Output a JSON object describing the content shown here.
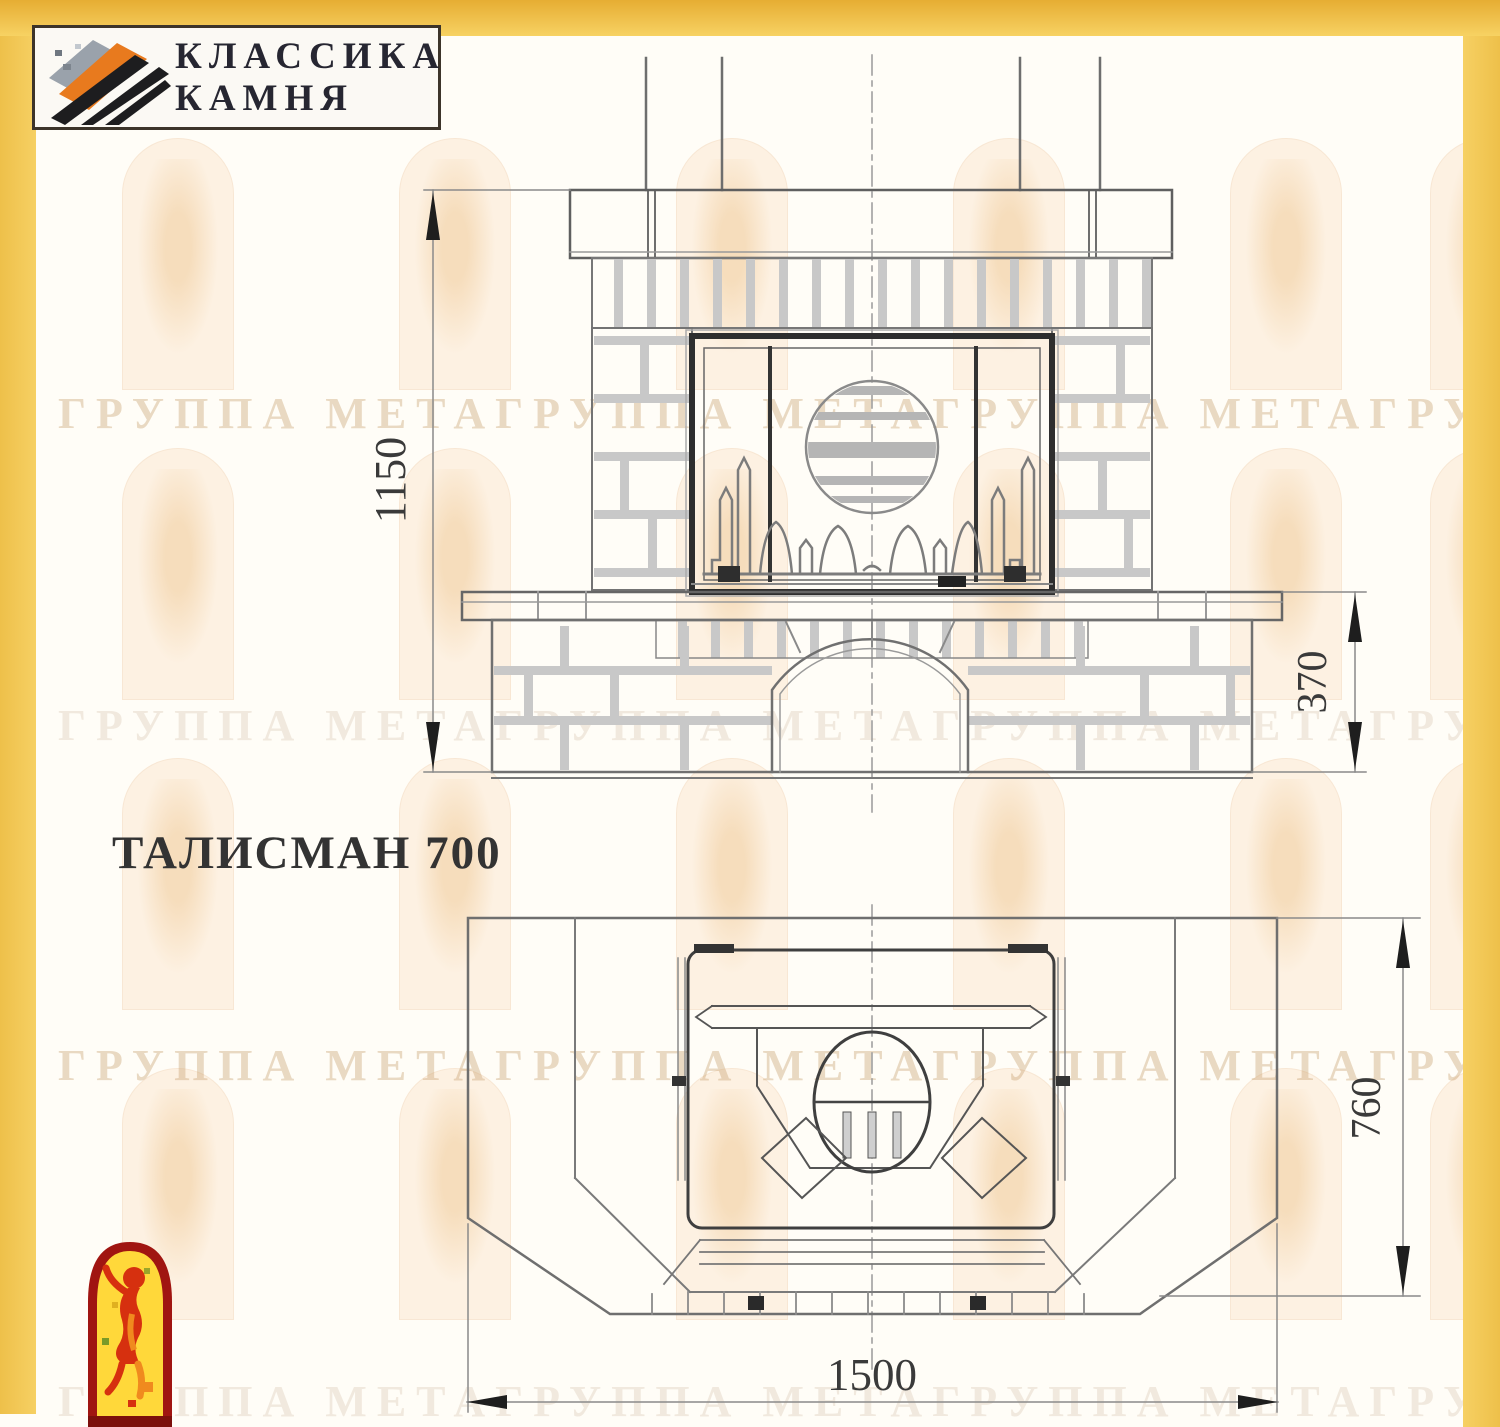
{
  "logo": {
    "line1": "КЛАССИКА",
    "line2": "КАМНЯ"
  },
  "title": "ТАЛИСМАН 700",
  "watermark": {
    "text": "ГРУППА МЕТАГРУППА МЕТАГРУППА МЕТАГРУППА МЕТАГРУППА МЕТА"
  },
  "drawing": {
    "front_view": {
      "dim_total_height": "1150",
      "dim_bench_height": "370"
    },
    "plan_view": {
      "dim_depth": "760",
      "dim_width": "1500"
    }
  },
  "colors": {
    "frame_gold": "#f1c54e",
    "line_gray": "#7a7a7a",
    "dark_frame": "#2e2e2e",
    "emblem_red": "#a01511",
    "emblem_yellow": "#ffd83a"
  }
}
